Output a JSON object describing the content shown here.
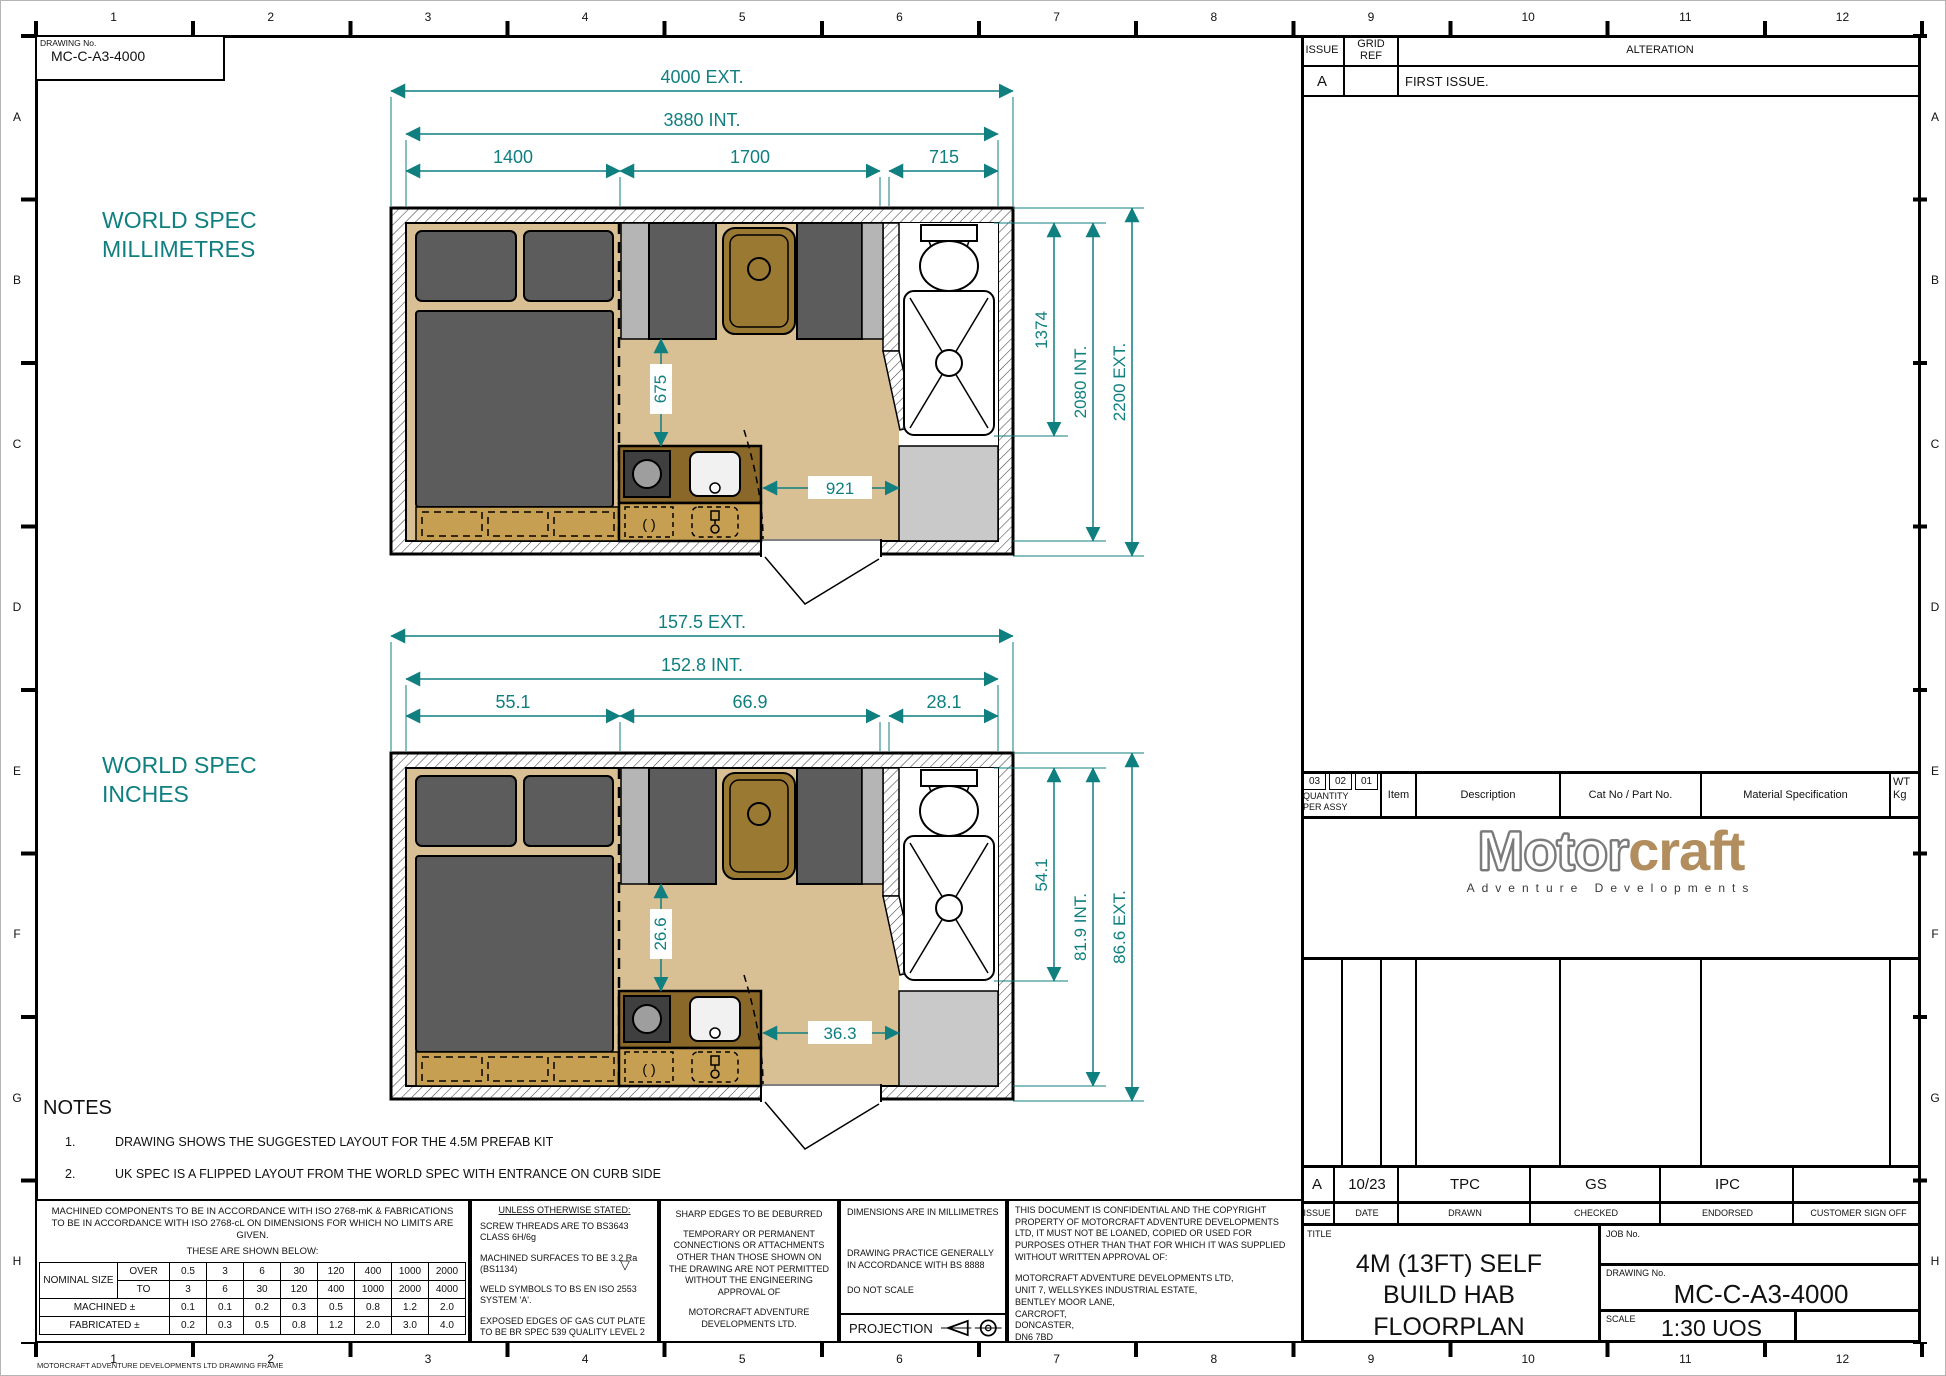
{
  "sheet": {
    "drawing_no_label": "DRAWING No.",
    "drawing_no": "MC-C-A3-4000",
    "frame_credit": "MOTORCRAFT ADVENTURE DEVELOPMENTS LTD DRAWING FRAME"
  },
  "grid": {
    "cols": [
      "1",
      "2",
      "3",
      "4",
      "5",
      "6",
      "7",
      "8",
      "9",
      "10",
      "11",
      "12"
    ],
    "rows": [
      "A",
      "B",
      "C",
      "D",
      "E",
      "F",
      "G",
      "H"
    ]
  },
  "alteration_table": {
    "issue_label": "ISSUE",
    "grid_ref_label": "GRID REF",
    "alteration_label": "ALTERATION",
    "row_issue": "A",
    "row_grid_ref": "",
    "row_alteration": "FIRST ISSUE."
  },
  "plans": [
    {
      "spec_line1": "WORLD SPEC",
      "spec_line2": "MILLIMETRES",
      "ext": "4000  EXT.",
      "int": "3880  INT.",
      "seg1": "1400",
      "seg2": "1700",
      "seg3": "715",
      "bath": "1374",
      "v_int": "2080 INT.",
      "v_ext": "2200 EXT.",
      "galley": "675",
      "door": "921"
    },
    {
      "spec_line1": "WORLD SPEC",
      "spec_line2": "INCHES",
      "ext": "157.5   EXT.",
      "int": "152.8   INT.",
      "seg1": "55.1",
      "seg2": "66.9",
      "seg3": "28.1",
      "bath": "54.1",
      "v_int": "81.9 INT.",
      "v_ext": "86.6 EXT.",
      "galley": "26.6",
      "door": "36.3"
    }
  ],
  "symbols": {
    "burner": "( )",
    "finish": "▽"
  },
  "notes": {
    "title": "NOTES",
    "item1_no": "1.",
    "item1": "DRAWING SHOWS THE SUGGESTED LAYOUT FOR THE 4.5M PREFAB KIT",
    "item2_no": "2.",
    "item2": "UK SPEC IS A FLIPPED LAYOUT FROM THE WORLD SPEC WITH ENTRANCE ON CURB SIDE"
  },
  "tolerance_block": {
    "para": "MACHINED COMPONENTS TO BE IN ACCORDANCE WITH ISO 2768-mK & FABRICATIONS TO BE IN ACCORDANCE WITH ISO 2768-cL ON DIMENSIONS FOR WHICH NO LIMITS ARE GIVEN.",
    "shown_below": "THESE ARE SHOWN BELOW:",
    "table": {
      "nominal_label": "NOMINAL SIZE",
      "over_label": "OVER",
      "to_label": "TO",
      "machined_label": "MACHINED ±",
      "fabricated_label": "FABRICATED ±",
      "over": [
        "0.5",
        "3",
        "6",
        "30",
        "120",
        "400",
        "1000",
        "2000"
      ],
      "to": [
        "3",
        "6",
        "30",
        "120",
        "400",
        "1000",
        "2000",
        "4000"
      ],
      "machined": [
        "0.1",
        "0.1",
        "0.2",
        "0.3",
        "0.5",
        "0.8",
        "1.2",
        "2.0"
      ],
      "fabricated": [
        "0.2",
        "0.3",
        "0.5",
        "0.8",
        "1.2",
        "2.0",
        "3.0",
        "4.0"
      ]
    }
  },
  "uos_block": {
    "heading": "UNLESS OTHERWISE STATED:",
    "items": [
      "SCREW THREADS ARE TO BS3643 CLASS 6H/6g",
      "MACHINED SURFACES TO BE 3.2 Ra (BS1134)",
      "WELD SYMBOLS TO BS EN ISO 2553 SYSTEM 'A'.",
      "EXPOSED EDGES OF GAS CUT PLATE TO BE BR SPEC 539 QUALITY LEVEL 2"
    ]
  },
  "connections_block": {
    "lines": [
      "SHARP EDGES TO BE DEBURRED",
      "TEMPORARY OR PERMANENT CONNECTIONS OR ATTACHMENTS OTHER THAN THOSE SHOWN ON THE DRAWING ARE NOT PERMITTED WITHOUT THE ENGINEERING APPROVAL OF",
      "MOTORCRAFT ADVENTURE DEVELOPMENTS LTD."
    ]
  },
  "dims_block": {
    "l1": "DIMENSIONS ARE IN MILLIMETRES",
    "l2": "DRAWING PRACTICE GENERALLY IN ACCORDANCE WITH BS 8888",
    "l3": "DO NOT SCALE",
    "projection_label": "PROJECTION"
  },
  "confidential_block": {
    "para": "THIS DOCUMENT IS CONFIDENTIAL AND THE COPYRIGHT PROPERTY OF MOTORCRAFT ADVENTURE DEVELOPMENTS LTD, IT MUST NOT BE LOANED, COPIED OR USED FOR PURPOSES OTHER THAN THAT FOR WHICH IT WAS SUPPLIED WITHOUT WRITTEN APPROVAL OF:",
    "address_lines": [
      "MOTORCRAFT ADVENTURE DEVELOPMENTS LTD,",
      "UNIT 7, WELLSYKES INDUSTRIAL ESTATE,",
      "BENTLEY MOOR LANE,",
      "CARCROFT,",
      "DONCASTER,",
      "DN6 7BD"
    ]
  },
  "parts_table": {
    "qty_cols": [
      "03",
      "02",
      "01"
    ],
    "qty_label1": "QUANTITY",
    "qty_label2": "PER ASSY",
    "item_label": "Item",
    "description_label": "Description",
    "cat_label": "Cat No / Part No.",
    "material_label": "Material Specification",
    "wt_label1": "WT",
    "wt_label2": "Kg"
  },
  "logo": {
    "word1": "Motor",
    "word2": "craft",
    "subtitle": "Adventure Developments"
  },
  "signoff": {
    "issue": "A",
    "date": "10/23",
    "drawn": "TPC",
    "checked": "GS",
    "endorsed": "IPC",
    "customer": "",
    "issue_label": "ISSUE",
    "date_label": "DATE",
    "drawn_label": "DRAWN",
    "checked_label": "CHECKED",
    "endorsed_label": "ENDORSED",
    "customer_label": "CUSTOMER SIGN OFF"
  },
  "title_block": {
    "title_label": "TITLE",
    "title": "4M (13FT) SELF BUILD HAB FLOORPLAN",
    "job_label": "JOB No.",
    "job": "",
    "drawing_label": "DRAWING No.",
    "drawing_no": "MC-C-A3-4000",
    "scale_label": "SCALE",
    "scale": "1:30 UOS"
  }
}
